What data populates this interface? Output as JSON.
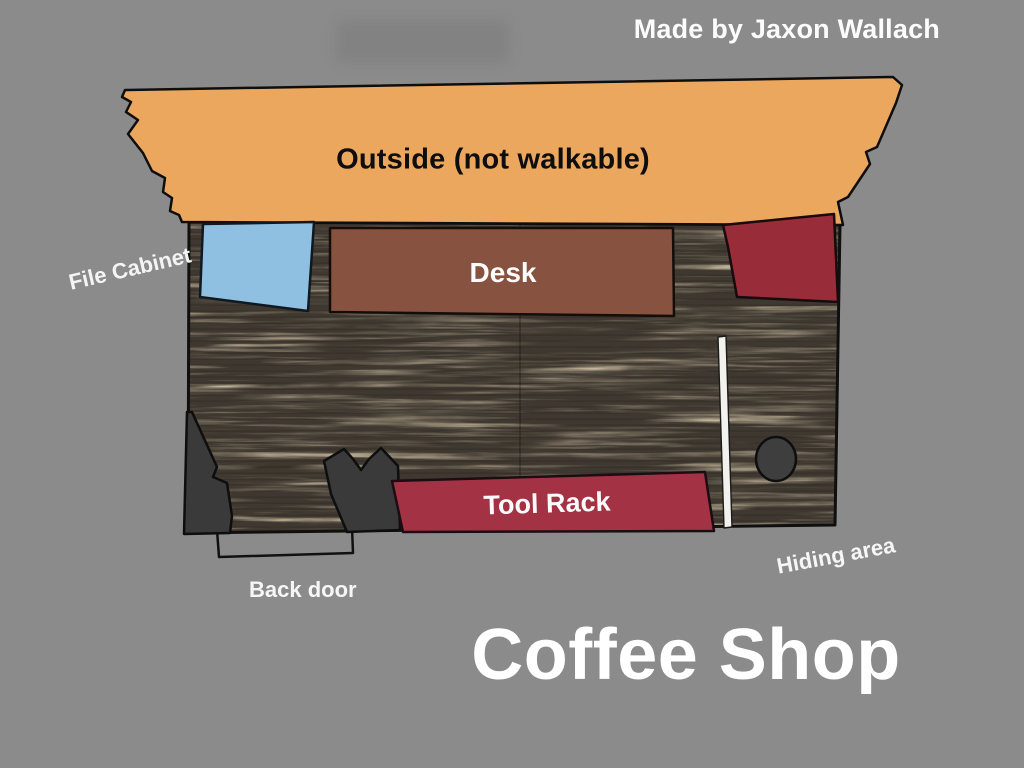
{
  "credit": "Made by Jaxon Wallach",
  "title": "Coffee Shop",
  "labels": {
    "outside": "Outside (not walkable)",
    "desk": "Desk",
    "file_cabinet": "File Cabinet",
    "tool_rack": "Tool Rack",
    "back_door": "Back door",
    "hiding_area": "Hiding area"
  },
  "colors": {
    "background": "#8B8B8B",
    "outside": "#ECA75E",
    "file_cabinet": "#8FC0E1",
    "desk": "#875240",
    "corner_shelf": "#982C39",
    "tool_rack": "#A43245",
    "dark_obstacle": "#3A3A3A",
    "hiding_circle": "#3E3E3E",
    "pole": "#F3F1ED",
    "floor_base": "#3A332A",
    "outline": "#101010",
    "text_light": "#FFFFFF",
    "text_dark": "#0E0E0E"
  }
}
